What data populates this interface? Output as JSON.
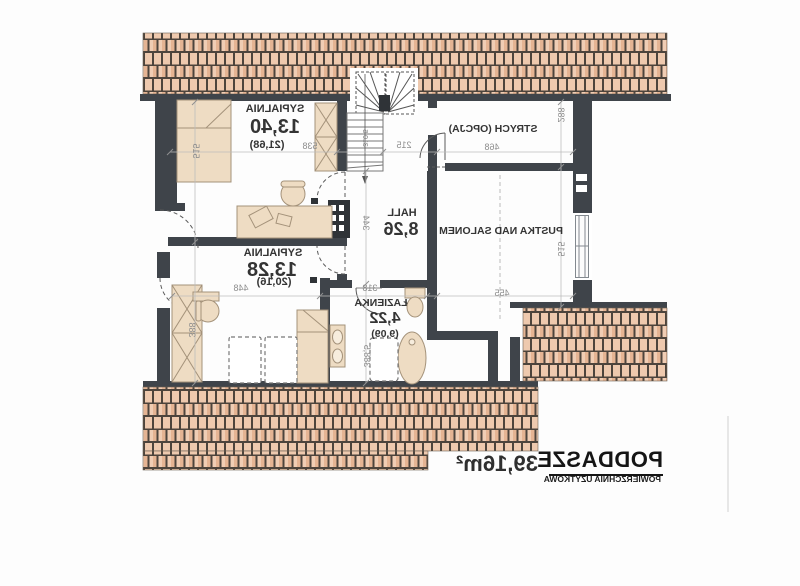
{
  "plan": {
    "rooms": {
      "bedroom1": {
        "name": "SYPIALNIA",
        "area": "13,40",
        "area_gross": "(21,68)"
      },
      "bedroom2": {
        "name": "SYPIALNIA",
        "area": "13,28",
        "area_gross": "(20,16)"
      },
      "hall": {
        "name": "HALL",
        "area": "8,26"
      },
      "bathroom": {
        "name": "ŁAZIENKA",
        "area": "4,22",
        "area_gross": "(9,09)"
      },
      "attic": {
        "name": "STRYCH (OPCJA)"
      },
      "void": {
        "name": "PUSTKA NAD SALONEM"
      }
    },
    "dims": {
      "bedroom1_w": "538",
      "bedroom1_h": "515",
      "bedroom2_w": "448",
      "bedroom2_h": "388",
      "hall_w": "215",
      "hall_h": "344",
      "bathroom_w": "318",
      "bathroom_h": "388,5",
      "attic_w": "468",
      "attic_h": "288",
      "void_w": "455",
      "void_h": "515",
      "stair_run": "310,5"
    },
    "title_block": {
      "title": "PODDASZE",
      "subtitle": "POWIERZCHNIA UŻYTKOWA",
      "area": "39,16m²"
    },
    "colors": {
      "wall": "#3f444a",
      "roof_tile": "#ecc5aa",
      "furniture": "#eedcc3",
      "dimension_text": "#8d8d8d"
    }
  }
}
